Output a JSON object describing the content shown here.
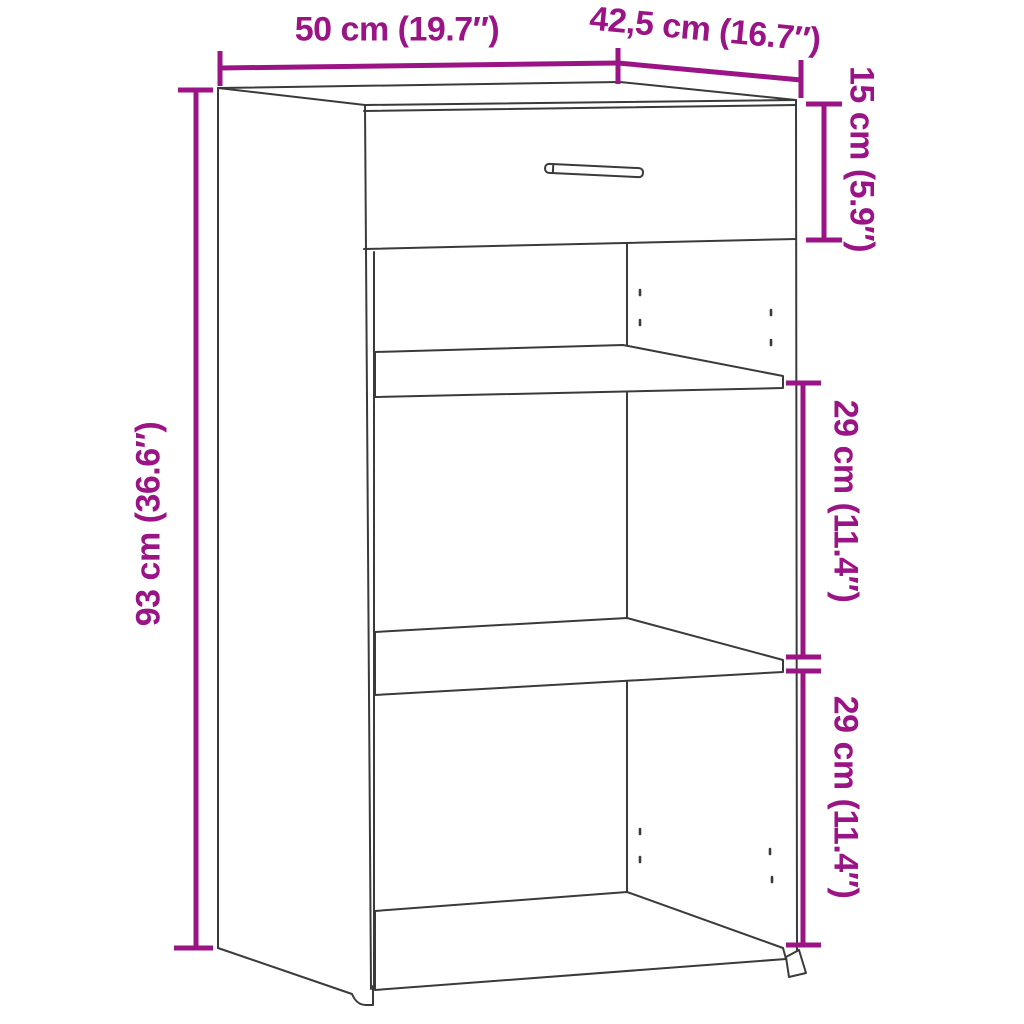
{
  "diagram": {
    "type": "furniture-dimension-diagram",
    "subject": "sideboard with one drawer and two open shelf compartments",
    "colors": {
      "dimension": "#9B1485",
      "outline": "#3a3a3a",
      "background": "#ffffff"
    },
    "dimensions": {
      "width": {
        "label": "50 cm (19.7″)",
        "value_cm": 50,
        "value_in": 19.7
      },
      "depth": {
        "label": "42,5 cm (16.7″)",
        "value_cm": 42.5,
        "value_in": 16.7
      },
      "height": {
        "label": "93 cm (36.6″)",
        "value_cm": 93,
        "value_in": 36.6
      },
      "drawer_height": {
        "label": "15 cm (5.9″)",
        "value_cm": 15,
        "value_in": 5.9
      },
      "compartment1_height": {
        "label": "29 cm (11.4″)",
        "value_cm": 29,
        "value_in": 11.4
      },
      "compartment2_height": {
        "label": "29 cm (11.4″)",
        "value_cm": 29,
        "value_in": 11.4
      }
    }
  }
}
